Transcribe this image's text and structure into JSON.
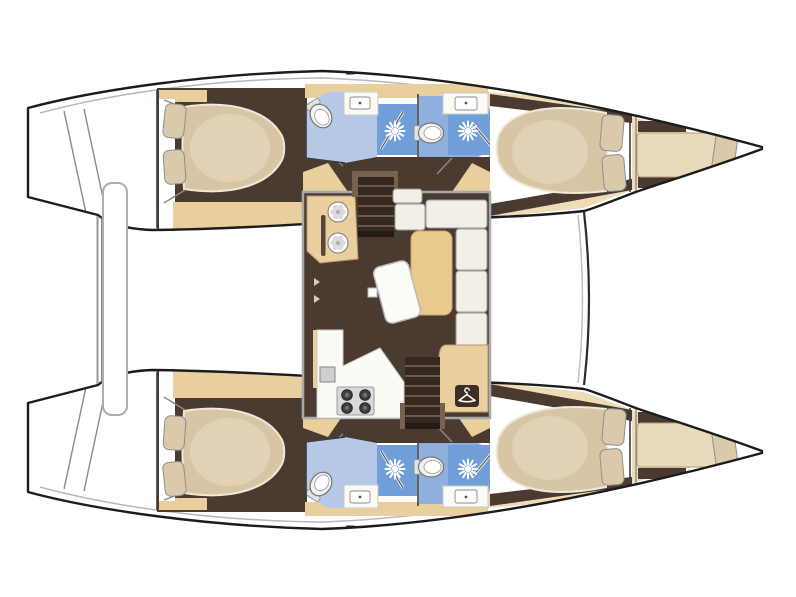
{
  "meta": {
    "type": "yacht-floor-plan",
    "subject": "catamaran",
    "view": "top-down",
    "orientation": {
      "bow": "right",
      "stern": "left"
    },
    "visible_text": []
  },
  "palette": {
    "white": "#ffffff",
    "outline": "#1c1c1c",
    "deck_line": "#b8b8b8",
    "floor": "#4b3a30",
    "stair": "#35291f",
    "stair_gap": "#6a564a",
    "stair_rim": "#77624f",
    "wood": "#e8cf9d",
    "deck_wood": "#eddcb6",
    "table_wood": "#eac98e",
    "counter": "#fbfaf5",
    "mattress": "#d8c5a5",
    "mattress_edge": "#f0e8d8",
    "mattress_hi": "#e7d9c1",
    "berth": "#e8dabc",
    "pillow": "#dbc9ac",
    "cushion": "#f2efe6",
    "bath_light": "#b5c9e7",
    "bath_mid": "#8fafdc",
    "shower_blue": "#6f9ed9",
    "metal": "#d9d9d9",
    "burner": "#3e3e3e",
    "wardrobe": "#3b2e24",
    "block_border": "#a9a9a9",
    "line_gray": "#8a8a8a"
  },
  "icons": {
    "shower-head": "white sunburst with spray rays",
    "wardrobe-hanger": "white clothes hanger in dark square",
    "galley-sink": "round basin with rosette pattern",
    "stove-burner": "dark circle with inner ring",
    "toilet": "oval bowl with cistern",
    "washbasin": "rectangle with drain dot"
  },
  "structure": {
    "hulls": [
      {
        "name": "port-hull",
        "rooms": [
          "aft-cabin-double-bed",
          "bathroom-with-toilet",
          "shower-room",
          "bathroom-with-toilet-2",
          "shower-room-2",
          "forward-cabin-double-bed",
          "forepeak-berth"
        ]
      },
      {
        "name": "starboard-hull",
        "rooms": [
          "aft-cabin-double-bed",
          "bathroom-with-toilet",
          "shower-room",
          "bathroom-with-toilet-2",
          "shower-room-2",
          "forward-cabin-double-bed",
          "forepeak-berth"
        ]
      }
    ],
    "saloon": {
      "features": [
        "galley-sink-unit-twin-basins",
        "companionway-stairs-port",
        "l-shaped-settee",
        "corner-table",
        "tilted-saloon-table",
        "galley-counter",
        "four-burner-stove",
        "small-sink",
        "wardrobe-with-hanger-icon",
        "companionway-stairs-starboard",
        "aft-seat"
      ]
    },
    "deck": [
      "transom-steps-port",
      "transom-steps-starboard",
      "aft-crossbeam-bar",
      "forward-bridgedeck-edge"
    ]
  }
}
